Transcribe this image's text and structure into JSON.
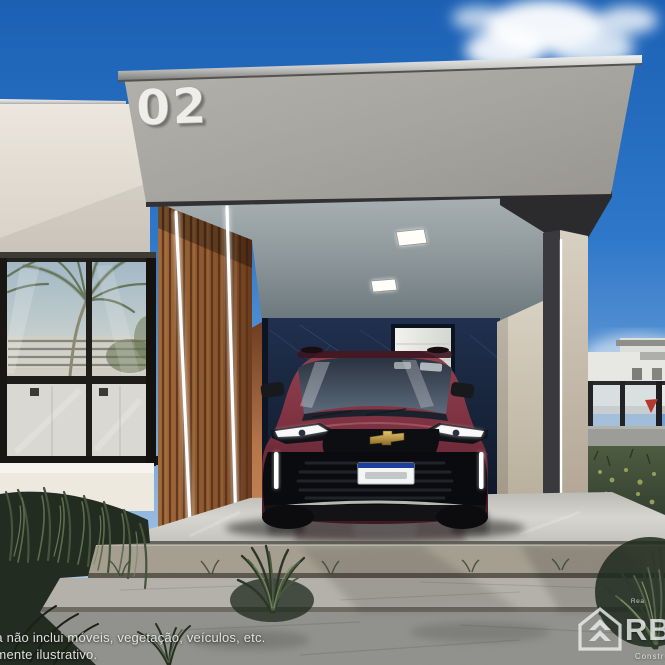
{
  "meta": {
    "description": "3D architectural rendering of a modern single-family house with carport and parked SUV"
  },
  "house": {
    "number": "02"
  },
  "disclaimer": {
    "line1": "da não inclui móveis, vegetação, veículos, etc.",
    "line2": "amente ilustrativo."
  },
  "watermark": {
    "top_text": "Rea",
    "brand": "RBA",
    "bottom_text": "Construt"
  },
  "car": {
    "badge_icon": "chevrolet-bowtie",
    "body_color": "#7c3140",
    "license_plate_style": "white with blue Mercosur band"
  },
  "palette": {
    "sky_top": "#1b60b4",
    "sky_horizon": "#b7d2ea",
    "facade_concrete": "#a7a5a0",
    "left_wall_cream": "#e9e4da",
    "wood_slats": "#8a5a34",
    "feature_wall_navy": "#17233a",
    "carport_ceiling": "#96a0a3",
    "column_beige": "#cdc5b6",
    "floor_stone": "#cfcfc9",
    "grass_dark": "#2f3a2b",
    "led_white": "#ffffff",
    "bowtie_gold": "#c8a24a"
  }
}
